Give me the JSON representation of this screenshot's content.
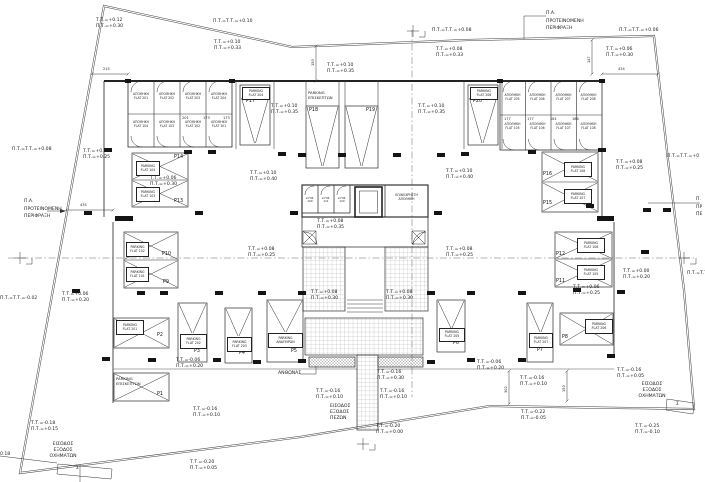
{
  "ann": [
    "Τ.Τ.=+0.12\nΠ.Τ.=+0.30",
    "Π.Τ.=Τ.Τ.=+0.10",
    "Τ.Τ.=+0.10\nΠ.Τ.=+0.33",
    "Π.Τ.=Τ.Τ.=+0.08",
    "Τ.Τ.=+0.08\nΠ.Τ.=+0.33",
    "Π.Τ.=Τ.Τ.=+0.06",
    "Τ.Τ.=+0.06\nΠ.Τ.=+0.30",
    "Π.Α.\nΠΡΟΤΕΙΝΟΜΕΝΗ\nΠΕΡΙΦΡΑΞΗ",
    "Τ.Τ.=+0.10\nΠ.Τ.=+0.35",
    "Τ.Τ.=+0.10\nΠ.Τ.=+0.35",
    "Τ.Τ.=+0.10\nΠ.Τ.=+0.35",
    "Π.Τ.=Τ.Τ.=+0.08",
    "Τ.Τ.=+0.08\nΠ.Τ.=+0.25",
    "Π.Α.\nΠΡΟΤΕΙΝΟΜΕΝΗ\nΠΕΡΙΦΡΑΞΗ",
    "Τ.Τ.=+0.06\nΠ.Τ.=+0.30",
    "Τ.Τ.=+0.10\nΠ.Τ.=+0.40",
    "Τ.Τ.=+0.10\nΠ.Τ.=+0.40",
    "Τ.Τ.=+0.08\nΠ.Τ.=+0.35",
    "Τ.Τ.=+0.08\nΠ.Τ.=+0.25",
    "Τ.Τ.=+0.08\nΠ.Τ.=+0.25",
    "Τ.Τ.=+0.08\nΠ.Τ.=+0.25",
    "Τ.Τ.=+0.08\nΠ.Τ.=+0.30",
    "Τ.Τ.=+0.08\nΠ.Τ.=+0.30",
    "Τ.Τ.=+0.06\nΠ.Τ.=+0.20",
    "Π.Τ.=Τ.Τ.=-0.02",
    "Τ.Τ.=+0.00\nΠ.Τ.=+0.20",
    "Τ.Τ.=+0.06\nΠ.Τ.=+0.25",
    "Τ.Τ.=-0.06\nΠ.Τ.=+0.20",
    "Τ.Τ.=-0.06\nΠ.Τ.=+0.20",
    "Τ.Τ.=-0.16\nΠ.Τ.=+0.30",
    "Τ.Τ.=-0.16\nΠ.Τ.=+0.10",
    "Τ.Τ.=-0.16\nΠ.Τ.=+0.10",
    "ΕΙΣΟΔΟΣ\nΕΞΟΔΟΣ\nΠΕΖΩΝ",
    "Τ.Τ.=-0.20\nΠ.Τ.=+0.00",
    "Τ.Τ.=-0.16\nΠ.Τ.=+0.10",
    "Τ.Τ.=-0.20\nΠ.Τ.=+0.05",
    "Τ.Τ.=-0.18\nΠ.Τ.=+0.15",
    "ΕΙΣΟΔΟΣ\nΕΞΟΔΟΣ\nΟΧΗΜΑΤΩΝ",
    "0.18",
    "Τ.Τ.=-0.16\nΠ.Τ.=+0.10",
    "Τ.Τ.=-0.16\nΠ.Τ.=+0.05",
    "ΕΙΣΟΔΟΣ\nΕΞΟΔΟΣ\nΟΧΗΜΑΤΩΝ",
    "Τ.Τ.=-0.22\nΠ.Τ.=-0.05",
    "Τ.Τ.=-0.25\nΠ.Τ.=-0.10",
    "Π.Τ.=Τ.Τ.=+0",
    "Π.Τ.=Τ.Τ",
    "Π.\nΠΡ\nΠΕ"
  ],
  "parking": {
    "visitors_label": "PARKING\nΕΠΙΣΚΕΠΤΩΝ",
    "stalls": [
      {
        "id": "P1",
        "label": "PARKING\nΕΠΙΣΚΕΠΤΩΝ"
      },
      {
        "id": "P2",
        "label": "PARKING\nFLAT 201"
      },
      {
        "id": "P3",
        "label": "PARKING\nFLAT 202"
      },
      {
        "id": "P4",
        "label": "PARKING\nFLAT 203"
      },
      {
        "id": "P5",
        "label": "PARKING\nΑΝΑΠΗΡΩΝ"
      },
      {
        "id": "P6",
        "label": "PARKING\nFLAT 205"
      },
      {
        "id": "P7",
        "label": "PARKING\nFLAT 207"
      },
      {
        "id": "P8",
        "label": "PARKING\nFLAT 206"
      },
      {
        "id": "P9",
        "label": "PARKING\nFLAT 101"
      },
      {
        "id": "P10",
        "label": "PARKING\nFLAT 102"
      },
      {
        "id": "P11",
        "label": "PARKING\nFLAT 105"
      },
      {
        "id": "P12",
        "label": "PARKING\nFLAT 106"
      },
      {
        "id": "P13",
        "label": "PARKING\nFLAT 103"
      },
      {
        "id": "P14",
        "label": "PARKING\nFLAT 104"
      },
      {
        "id": "P15",
        "label": "PARKING\nFLAT 107"
      },
      {
        "id": "P16",
        "label": "PARKING\nFLAT 108"
      },
      {
        "id": "P17",
        "label": "PARKING\nFLAT 204"
      },
      {
        "id": "P18",
        "label": ""
      },
      {
        "id": "P19",
        "label": ""
      },
      {
        "id": "P20",
        "label": "PARKING\nFLAT 208"
      }
    ]
  },
  "storage": {
    "left": {
      "top": [
        "ΑΠΟΘΗΚΗ\nFLAT 201",
        "ΑΠΟΘΗΚΗ\nFLAT 202",
        "ΑΠΟΘΗΚΗ\nFLAT 203",
        "ΑΠΟΘΗΚΗ\nFLAT 204"
      ],
      "bottom": [
        "ΑΠΟΘΗΚΗ\nFLAT 104",
        "ΑΠΟΘΗΚΗ\nFLAT 103",
        "ΑΠΟΘΗΚΗ\nFLAT 102",
        "ΑΠΟΘΗΚΗ\nFLAT 101"
      ],
      "dims": [
        "201",
        "173",
        "173"
      ]
    },
    "right": {
      "top": [
        "ΑΠΟΘΗΚΗ\nFLAT 205",
        "ΑΠΟΘΗΚΗ\nFLAT 206",
        "ΑΠΟΘΗΚΗ\nFLAT 207",
        "ΑΠΟΘΗΚΗ\nFLAT 208"
      ],
      "bottom": [
        "ΑΠΟΘΗΚΗ\nFLAT 105",
        "ΑΠΟΘΗΚΗ\nFLAT 106",
        "ΑΠΟΘΗΚΗ\nFLAT 107",
        "ΑΠΟΘΗΚΗ\nFLAT 108"
      ],
      "dims": [
        "177",
        "177",
        "181",
        "188"
      ]
    }
  },
  "core": {
    "rooms": [
      "Α.Η.Β.\n100",
      "Α.Η.Β.\n111",
      "Α.Η.Β.\n120"
    ],
    "communal": "ΚΟΙΝΟΧΡΗΣΤΗ\nΑΠΟΘΗΚΗ"
  },
  "site": {
    "garden": "ΑΝΘΩΝΑΣ",
    "stair": "Σ"
  },
  "dims": {
    "d215": "215",
    "d435": "435",
    "d434": "434",
    "d150a": "150",
    "d147": "147",
    "d302": "302",
    "d150b": "150"
  }
}
